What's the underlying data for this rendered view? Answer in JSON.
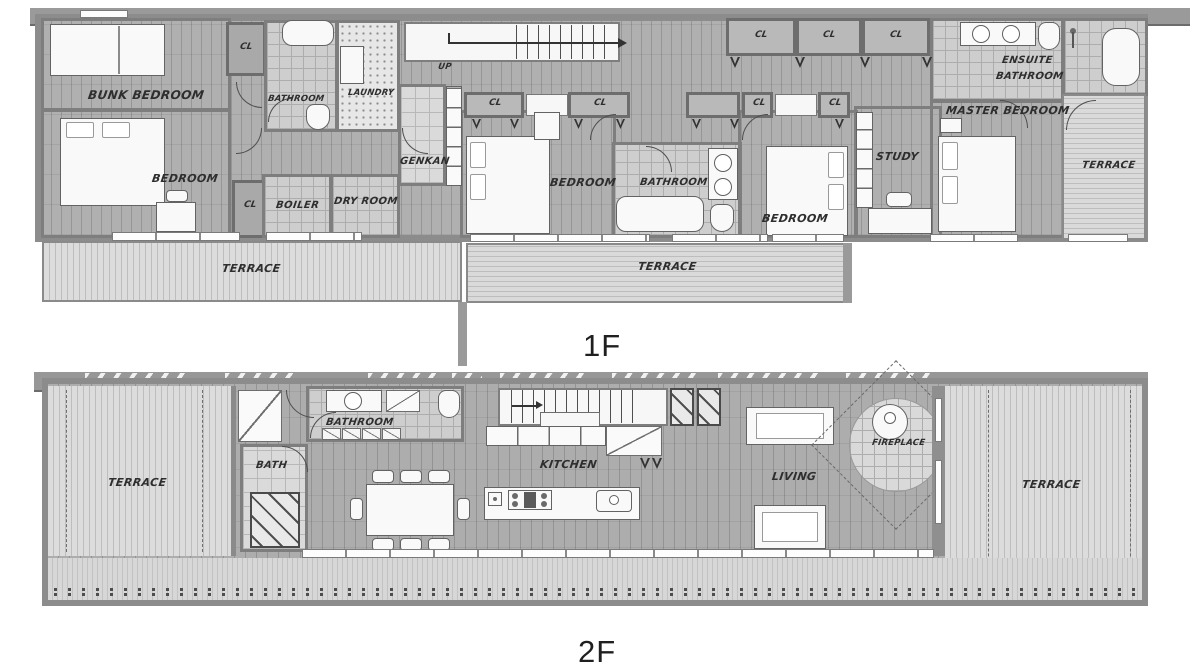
{
  "title": "House floor plan – two storeys",
  "floor1": {
    "name": "1F",
    "closet": "CL",
    "rooms": {
      "bunk_bedroom": "BUNK BEDROOM",
      "bedroom_west": "BEDROOM",
      "bathroom_west": "BATHROOM",
      "laundry": "LAUNDRY",
      "stairs_up": "UP",
      "genkan": "GENKAN",
      "boiler": "BOILER",
      "dry_room": "DRY ROOM",
      "bedroom_center": "BEDROOM",
      "bathroom_center": "BATHROOM",
      "bedroom_east": "BEDROOM",
      "study": "STUDY",
      "master_bedroom": "MASTER BEDROOM",
      "ensuite_line1": "ENSUITE",
      "ensuite_line2": "BATHROOM",
      "terrace_southwest": "TERRACE",
      "terrace_south": "TERRACE",
      "terrace_east": "TERRACE"
    }
  },
  "floor2": {
    "name": "2F",
    "rooms": {
      "terrace_west": "TERRACE",
      "bath": "BATH",
      "bathroom": "BATHROOM",
      "kitchen": "KITCHEN",
      "living": "LIVING",
      "fireplace": "FIREPLACE",
      "terrace_east": "TERRACE"
    }
  },
  "colors": {
    "wall": "#8c8c8c",
    "wood_floor": "#a8a8a8",
    "deck": "#d6d6d6",
    "tile": "#cecece",
    "label": "#2e2e2e",
    "background": "#ffffff"
  }
}
